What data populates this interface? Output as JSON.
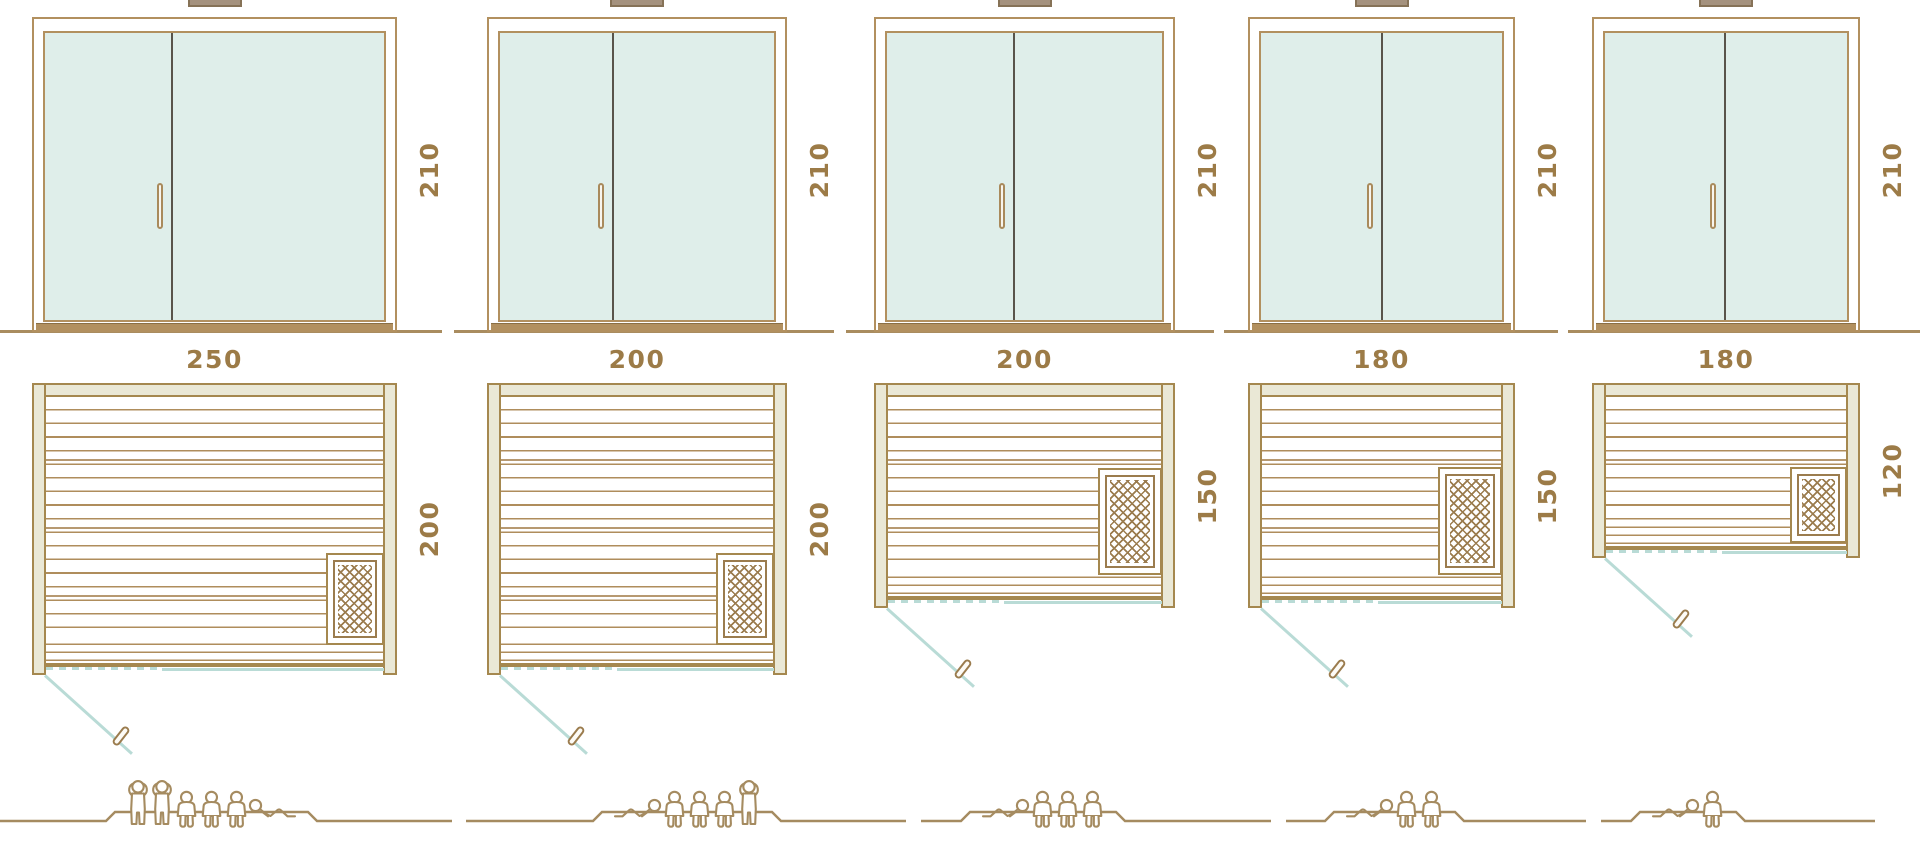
{
  "diagram": {
    "description_name": "sauna-size-comparison-diagram",
    "palette": {
      "frame_brown": "#b2905f",
      "wall_beige": "#eae8d6",
      "wall_line_brown": "#a5884f",
      "glass_teal": "#dfeeea",
      "door_swing_blue": "#b9dbd6",
      "label_brown": "#9c7b47",
      "figure_khaki": "#a58b60",
      "door_divider_dark": "#59544b"
    }
  },
  "units": [
    {
      "name": "unit-250x200",
      "height_cm": "210",
      "width_cm": "250",
      "depth_cm": "200",
      "capacity": 6,
      "figures": [
        "standing",
        "standing",
        "seated",
        "seated",
        "seated",
        "lying-right"
      ]
    },
    {
      "name": "unit-200x200",
      "height_cm": "210",
      "width_cm": "200",
      "depth_cm": "200",
      "capacity": 5,
      "figures": [
        "lying-left",
        "seated",
        "seated",
        "seated",
        "standing"
      ]
    },
    {
      "name": "unit-200x150",
      "height_cm": "210",
      "width_cm": "200",
      "depth_cm": "150",
      "capacity": 4,
      "figures": [
        "lying-left",
        "seated",
        "seated",
        "seated"
      ]
    },
    {
      "name": "unit-180x150",
      "height_cm": "210",
      "width_cm": "180",
      "depth_cm": "150",
      "capacity": 3,
      "figures": [
        "lying-left",
        "seated",
        "seated"
      ]
    },
    {
      "name": "unit-180x120",
      "height_cm": "210",
      "width_cm": "180",
      "depth_cm": "120",
      "capacity": 2,
      "figures": [
        "lying-left",
        "seated"
      ]
    }
  ]
}
